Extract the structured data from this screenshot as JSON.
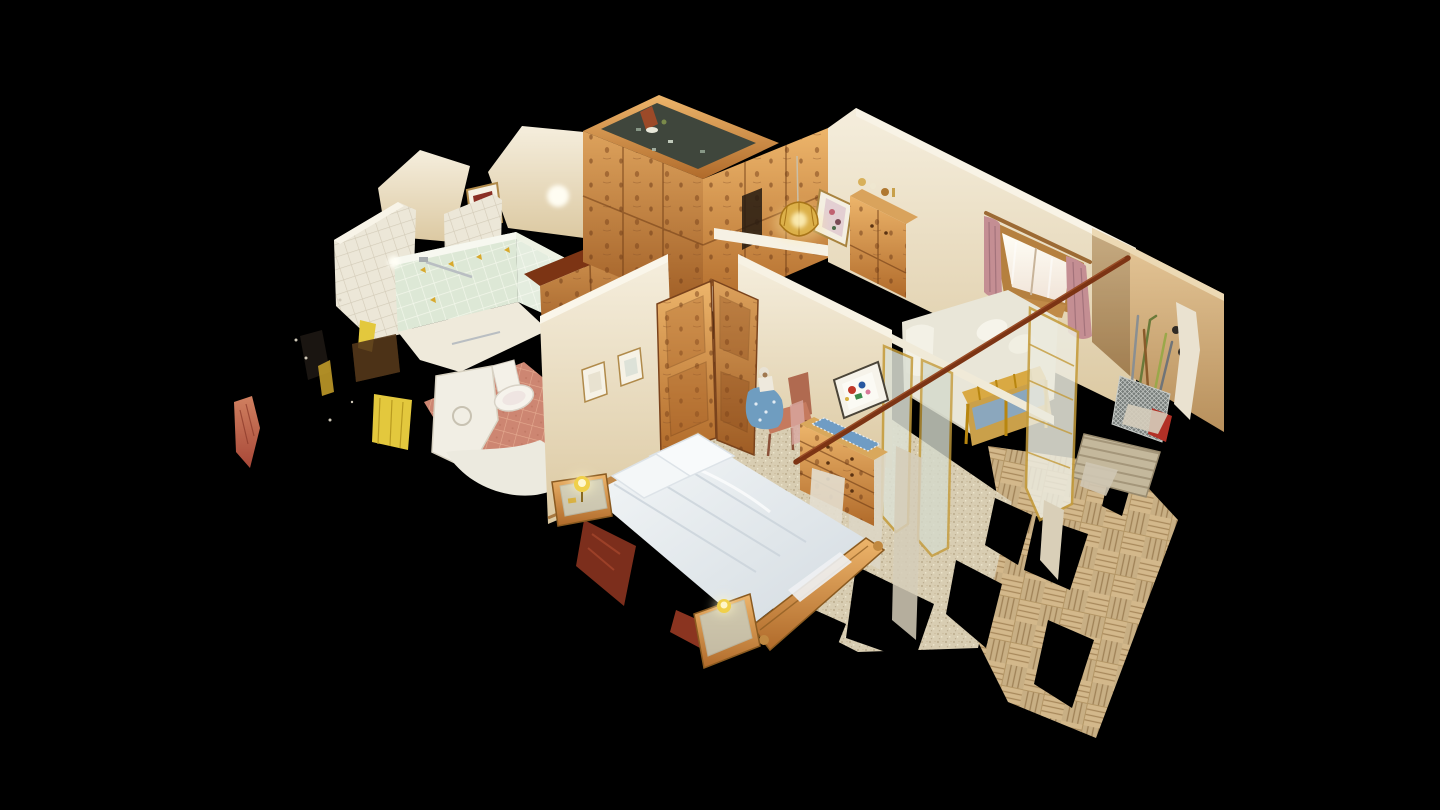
{
  "viewer": {
    "type": "3d-dollhouse-tour-viewer",
    "view_mode": "dollhouse-cutaway",
    "background": "#000000"
  },
  "palette": {
    "bg": "#000000",
    "wall-cream": "#ede3cd",
    "wall-cream-dark": "#d9c5a0",
    "wall-white": "#f5f1e6",
    "wall-tan": "#d8b384",
    "wood-light": "#dda25c",
    "wood-mid": "#b4712f",
    "wood-dark": "#8a4d1d",
    "wood-red": "#7c3414",
    "tile-white": "#ece7d8",
    "tile-grout": "#d3cbb8",
    "tile-mint": "#dde8d6",
    "tile-mint-grout": "#f3f7eb",
    "floor-pink": "#cd8672",
    "floor-pink-grout": "#e5ab90",
    "carpet": "#d8cdb2",
    "carpet-dot": "#b3a283",
    "parquet": "#d3b88b",
    "parquet-dark": "#a8895c",
    "bed-white": "#eaeef1",
    "bed-shadow": "#c9d2d9",
    "blanket-red": "#7c2e1c",
    "lamp-yellow": "#f0d04a",
    "lamp-glow": "#fff3b0",
    "curtain-pink": "#c48e93",
    "window-glass": "#fdfbf2",
    "runner-blue": "#6f9cc4",
    "cushion-blue": "#8ba7bd",
    "doll-blue": "#6f9dc0",
    "towel-yellow": "#e3c83d",
    "counter-dark": "#3f463c",
    "accent-red": "#b23026",
    "metal-grey": "#9aa0a2",
    "frame-gold": "#c49b3a",
    "mat-grey": "#c4b89c"
  },
  "scene": {
    "description": "isometric dollhouse cutaway of a small pine-furnished apartment on black void",
    "rooms": [
      {
        "name": "kitchen",
        "objects": [
          "knotty-pine-cabinets",
          "dark-speckled-countertop",
          "counter-items"
        ]
      },
      {
        "name": "bathroom",
        "objects": [
          "white-tiled-wall",
          "mint-tiled-shower-walls",
          "shower-rail",
          "toilet",
          "washing-machine",
          "shower-tray",
          "yellow-towels",
          "terracotta-tile-floor"
        ]
      },
      {
        "name": "bedroom",
        "objects": [
          "double-bed-white-duvet",
          "pillows",
          "red-blanket",
          "pine-footboard",
          "bedside-tables-with-lamps",
          "pine-double-doors",
          "pine-wardrobe-row",
          "dresser-with-blue-runner",
          "leaning-abstract-painting",
          "chair-with-doll",
          "two-framed-pictures",
          "beige-speckled-carpet"
        ]
      },
      {
        "name": "living-area",
        "objects": [
          "window-with-pink-curtains",
          "white-daybed",
          "slatted-wooden-bench",
          "pine-cupboard",
          "tiffany-pendant-lamp",
          "framed-wall-picture",
          "gold-framed-glass-doors"
        ]
      },
      {
        "name": "entry-hall",
        "objects": [
          "basketweave-parquet-floor",
          "doormat",
          "wire-stick-basket",
          "walking-sticks",
          "red-case",
          "scan-fragments"
        ]
      }
    ],
    "artifacts": [
      "black-scan-holes",
      "torn-mesh-edges",
      "fallen-curtain-rod",
      "floating-debris-left"
    ]
  }
}
